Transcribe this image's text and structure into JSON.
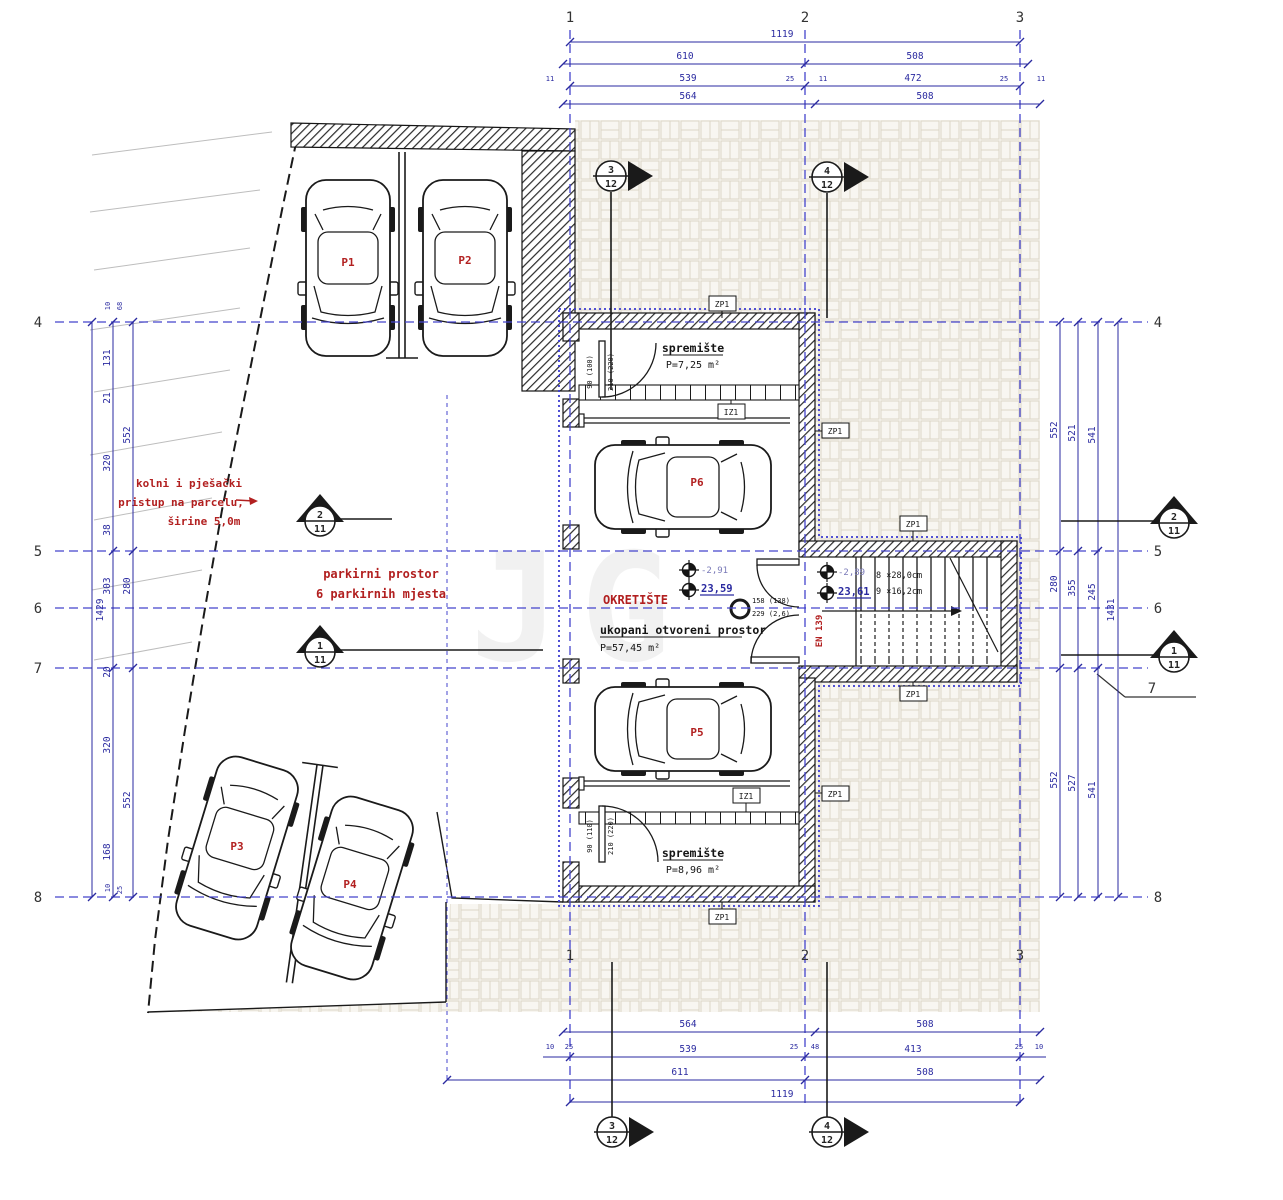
{
  "g": {
    "c1": "1",
    "c2": "2",
    "c3": "3",
    "r4": "4",
    "r5": "5",
    "r6": "6",
    "r7": "7",
    "r8": "8"
  },
  "mk": {
    "n1": "1",
    "n2": "2",
    "n3": "3",
    "n4": "4",
    "d11": "11",
    "d12": "12"
  },
  "d": {
    "v1119": "1119",
    "v610": "610",
    "v508": "508",
    "v539": "539",
    "v472": "472",
    "v564": "564",
    "v413": "413",
    "v611": "611",
    "v1429": "1429",
    "v1431": "1431",
    "v131": "131",
    "v21": "21",
    "v320": "320",
    "v38": "38",
    "v303": "303",
    "v280": "280",
    "v552": "552",
    "v521": "521",
    "v541": "541",
    "v527": "527",
    "v355": "355",
    "v245": "245",
    "v20": "20",
    "v168": "168",
    "v10": "10",
    "v25": "25",
    "v48": "48",
    "v11": "11",
    "v68": "68"
  },
  "t": {
    "access1": "kolni i pješački",
    "access2": "pristup na parcelu,",
    "access3": "širine 5,0m",
    "park1": "parkirni prostor",
    "park2": "6 parkirnih mjesta",
    "okret": "OKRETIŠTE",
    "open1": "ukopani otvoreni prostor",
    "open2": "P=57,45 m²",
    "sprem": "spremište",
    "a725": "P=7,25 m²",
    "a896": "P=8,96 m²",
    "stair1": "8 ×28,0cm",
    "stair2": "9 ×16,2cm",
    "en": "EN 139",
    "lvl1u": "-2,91",
    "lvl1d": "23,59",
    "lvl2u": "-2,89",
    "lvl2d": "23,61",
    "zp": "ZP1",
    "iz": "IZ1",
    "d1a": "90 (100)",
    "d1b": "210 (220)",
    "d2a": "90 (110)",
    "d2b": "210 (220)",
    "d3a": "158 (138)",
    "d3b": "229 (2,6)",
    "wm": "JG"
  },
  "cars": [
    "P1",
    "P2",
    "P3",
    "P4",
    "P5",
    "P6"
  ],
  "colors": {
    "dim": "#2a2aa0",
    "grid": "#4444cc",
    "red": "#b22020",
    "black": "#151515",
    "paver": "#dcd6c6"
  }
}
